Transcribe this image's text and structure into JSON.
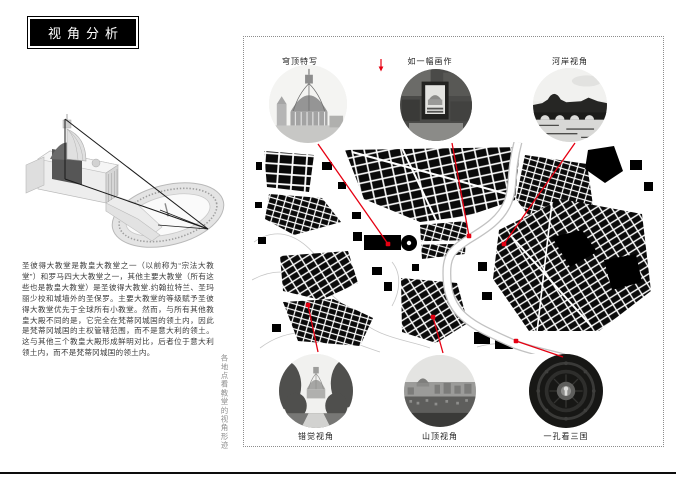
{
  "page": {
    "title": "视角分析"
  },
  "left_column": {
    "description": "圣彼得大教堂是教皇大教堂之一（以前称为“宗法大教堂”）和罗马四大大教堂之一，其他主要大教堂（所有这些也是教皇大教堂）是圣彼得大教堂.约翰拉特兰、圣玛丽少校和城墙外的圣保罗。主要大教堂的等级赋予圣彼得大教堂优先于全球所有小教堂。然而，与所有其他教皇大殿不同的是，它完全在梵蒂冈城国的领土内，因此是梵蒂冈城国的主权管辖范围，而不是意大利的领土。这与其他三个教皇大殿形成鲜明对比，后者位于意大利领土内，而不是梵蒂冈城国的领土内。",
    "vertical_caption": "各地点看教堂的视角形迹"
  },
  "panel": {
    "accent_color": "#e60012",
    "viewpoints": [
      {
        "label": "穹顶特写"
      },
      {
        "label": "如一幅画作"
      },
      {
        "label": "河岸视角"
      },
      {
        "label": "错觉视角"
      },
      {
        "label": "山顶视角"
      },
      {
        "label": "一孔看三国"
      }
    ]
  }
}
